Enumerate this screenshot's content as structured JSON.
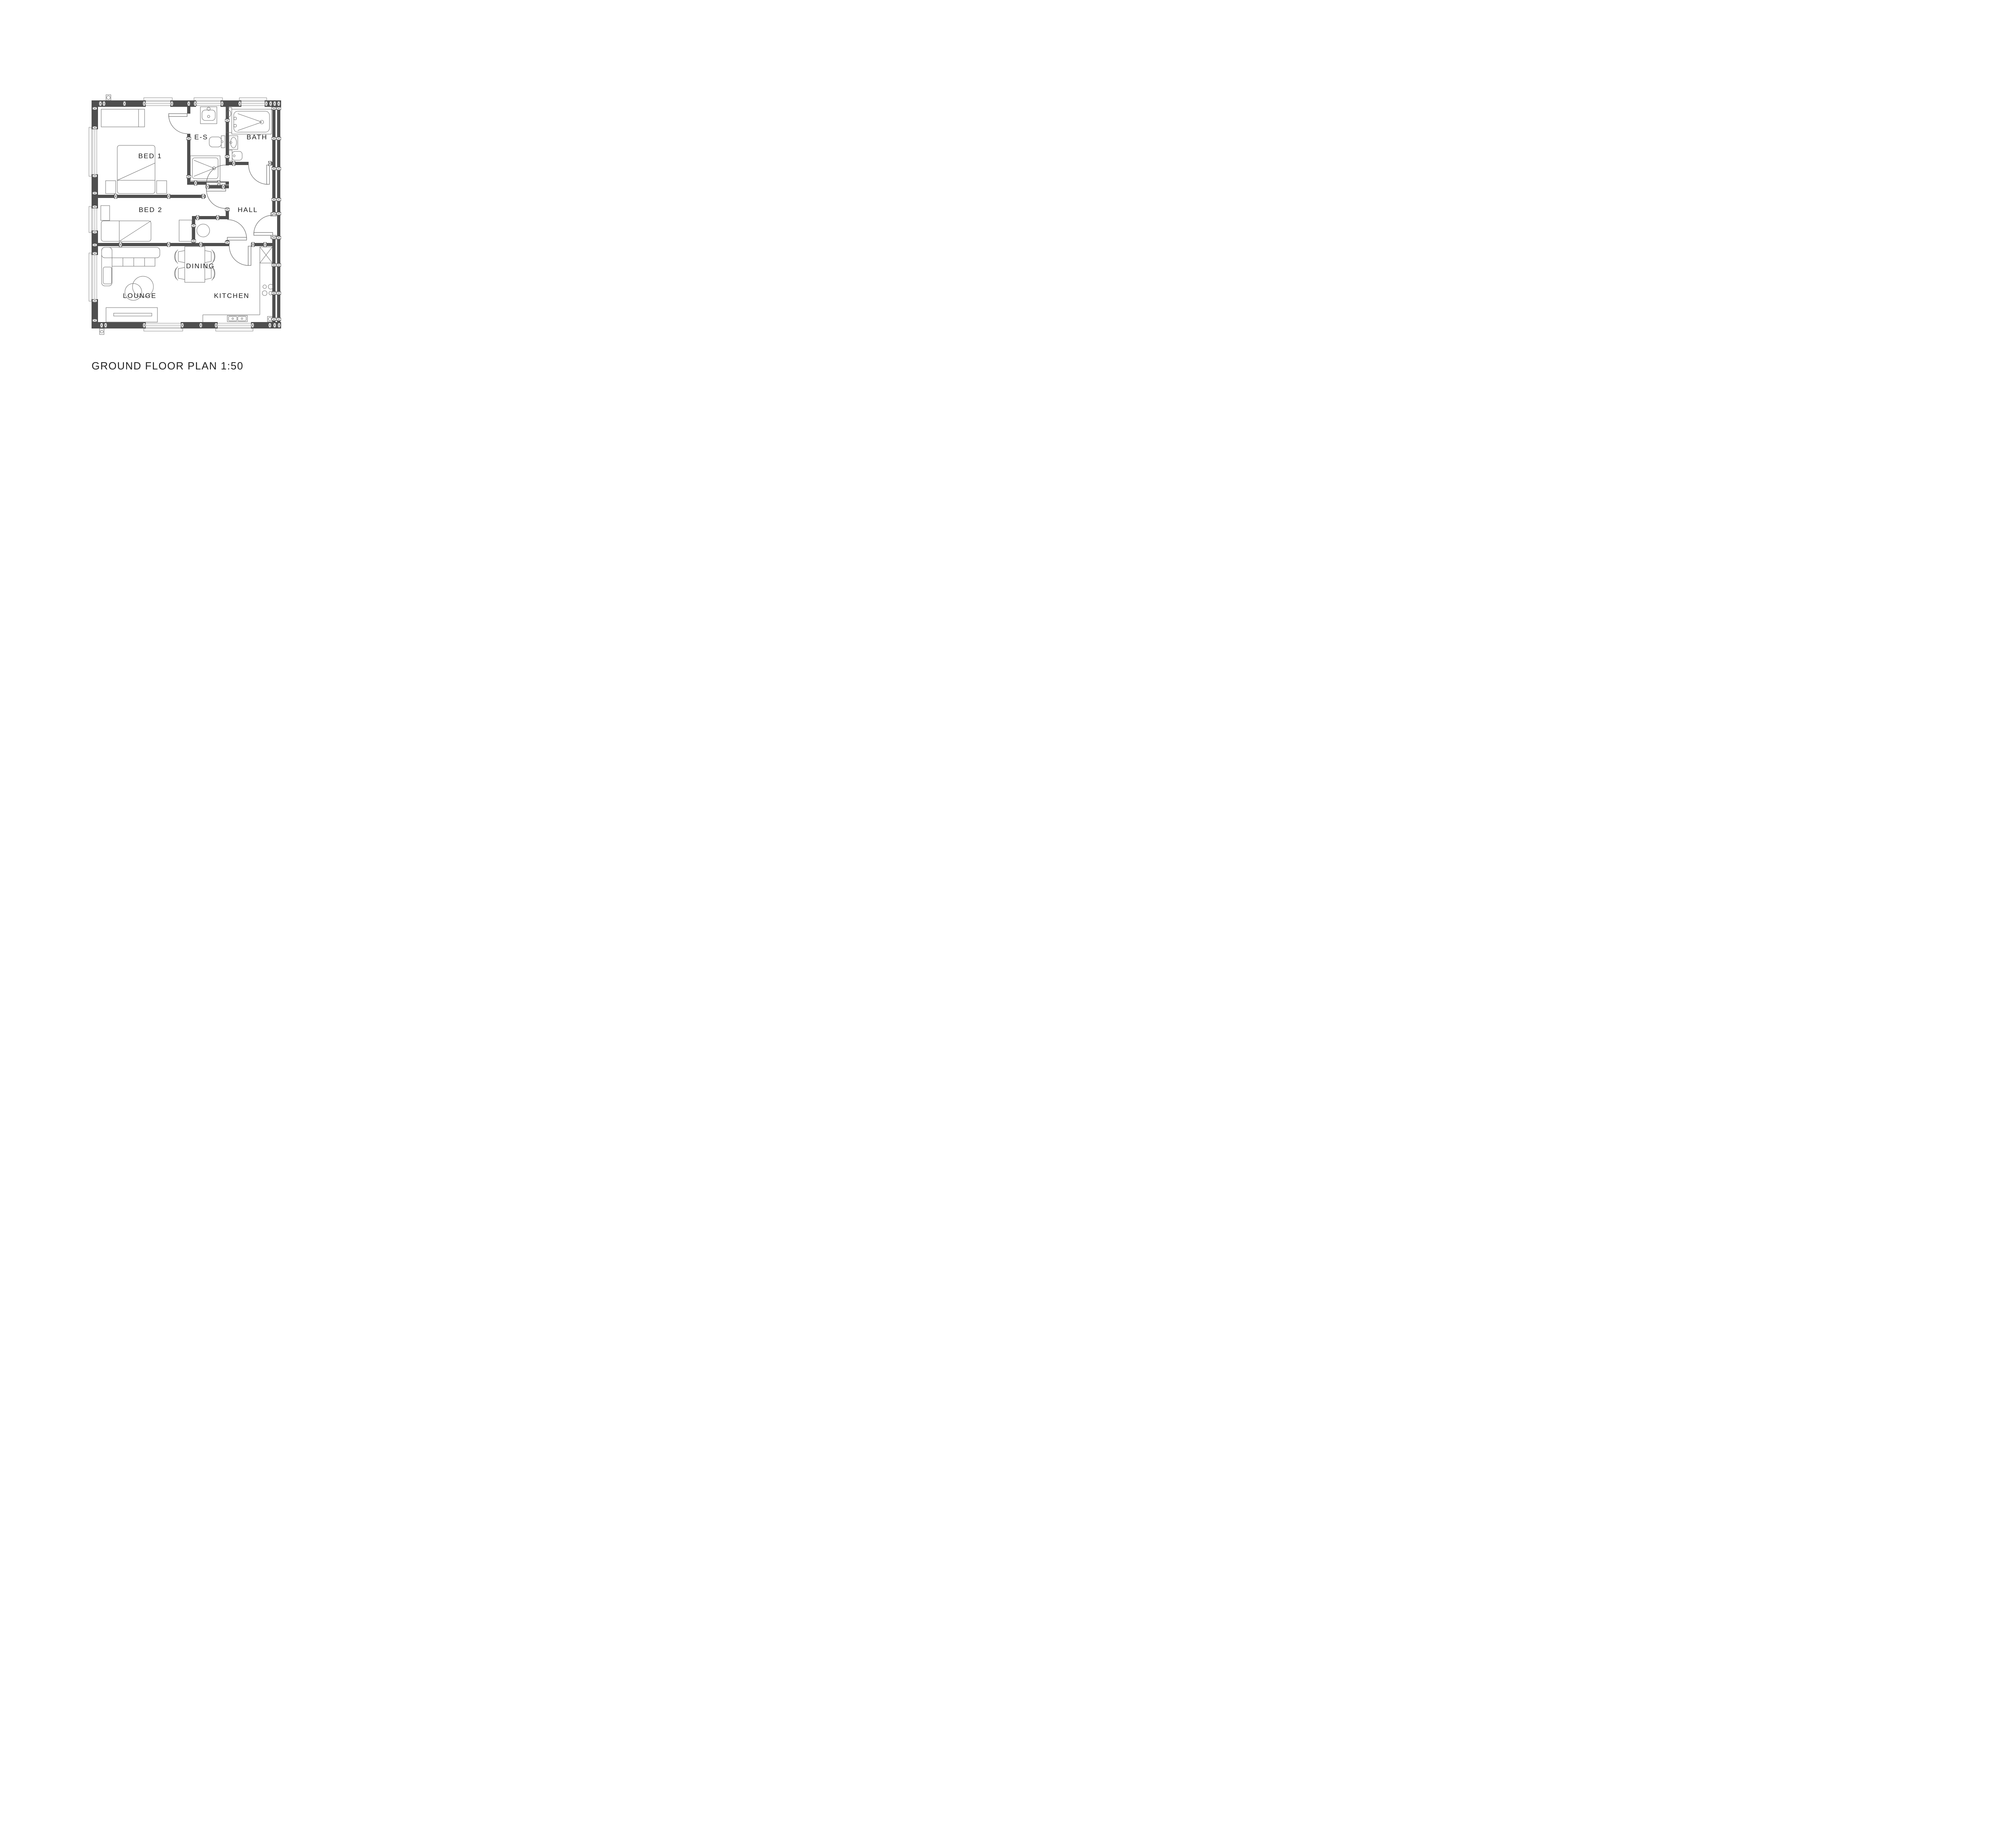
{
  "drawing": {
    "title": "GROUND FLOOR PLAN 1:50",
    "scale": "1:50",
    "rooms": [
      {
        "id": "bed1",
        "label": "BED 1"
      },
      {
        "id": "bed2",
        "label": "BED 2"
      },
      {
        "id": "ensuite",
        "label": "E-S"
      },
      {
        "id": "bath",
        "label": "BATH"
      },
      {
        "id": "hall",
        "label": "HALL"
      },
      {
        "id": "dining",
        "label": "DINING"
      },
      {
        "id": "lounge",
        "label": "LOUNGE"
      },
      {
        "id": "kitchen",
        "label": "KITCHEN"
      }
    ],
    "colors": {
      "wall": "#4f4f4f",
      "line": "#6b6b6b",
      "label": "#1c1c1c",
      "background": "#ffffff"
    }
  }
}
